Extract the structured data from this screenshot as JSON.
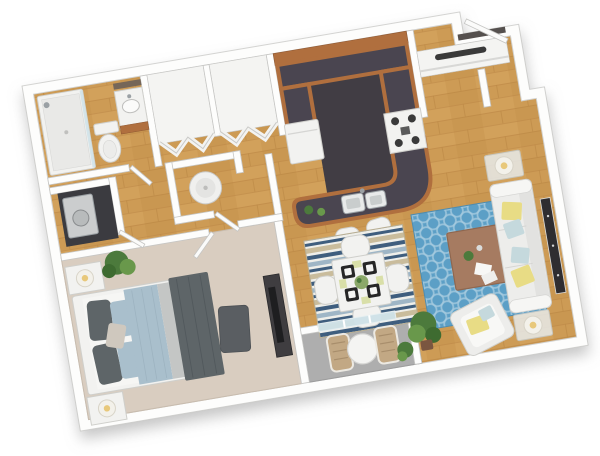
{
  "scene": {
    "type": "3d-floorplan-render",
    "view": "top-down axonometric",
    "unit": "one-bedroom one-bath apartment",
    "rooms": [
      {
        "name": "bathroom",
        "floor": "wood",
        "fixtures": [
          "walk-in shower",
          "toilet",
          "vanity with sink and mirror"
        ]
      },
      {
        "name": "hall-closet-a",
        "floor": "white",
        "fixtures": [
          "bifold doors"
        ]
      },
      {
        "name": "hall-closet-b",
        "floor": "white",
        "fixtures": [
          "bifold doors"
        ]
      },
      {
        "name": "utility-closet",
        "floor": "wood",
        "fixtures": [
          "water heater"
        ]
      },
      {
        "name": "laundry-closet",
        "floor": "dark",
        "fixtures": [
          "stacked washer-dryer"
        ]
      },
      {
        "name": "hallway",
        "floor": "wood",
        "fixtures": []
      },
      {
        "name": "bedroom",
        "floor": "carpet",
        "fixtures": [
          "bed with gray comforter and blue pillows",
          "nightstand with lamp x2",
          "ottoman",
          "media dresser with tv",
          "potted plant"
        ]
      },
      {
        "name": "kitchen",
        "floor": "dark tile",
        "fixtures": [
          "u-shaped wood cabinets with charcoal counters",
          "refrigerator",
          "range with burners",
          "peninsula with double sink",
          "bar stool x2",
          "herb plants x2"
        ]
      },
      {
        "name": "entry",
        "floor": "wood",
        "fixtures": [
          "front door (open)",
          "coat closet with shelf and rod"
        ]
      },
      {
        "name": "dining-area",
        "floor": "wood",
        "fixtures": [
          "striped area rug",
          "square white table",
          "dining chair x4",
          "black placemats x4",
          "green centerpiece"
        ]
      },
      {
        "name": "living-room",
        "floor": "wood",
        "fixtures": [
          "blue trellis rug",
          "wood coffee table",
          "white sofa with yellow and blue pillows",
          "glass side table with lamp x2",
          "armchair with yellow pillow",
          "wall tv console",
          "potted plant"
        ]
      },
      {
        "name": "balcony",
        "floor": "concrete",
        "fixtures": [
          "sliding glass door",
          "round bistro table",
          "patio chair x2",
          "potted plant"
        ]
      }
    ]
  },
  "colors": {
    "wall_fill": "#fdfdfc",
    "wall_stroke": "#c6c6c4",
    "closet_int": "#f4f4f2",
    "floor_wood": "#cd9b55",
    "wood_seam": "#b5813f",
    "wood_light": "#ddac67",
    "carpet": "#d9cdc0",
    "carpet_edge": "#c8bcae",
    "balcony_floor": "#aeaeae",
    "kitchen_floor": "#413d44",
    "counter": "#4a4550",
    "cabinet_wood": "#b06f3e",
    "cabinet_wood_dark": "#8f5832",
    "furn_white": "#f2f2f0",
    "furn_stroke": "#cfcfcb",
    "door_leaf": "#fbfbfa",
    "rug_blue": "#5c9fc6",
    "rug_trellis": "#a6cbdf",
    "stripe_navy": "#3f5e7e",
    "stripe_tan": "#c9bc9c",
    "stripe_blue": "#9fb6c6",
    "stripe_white": "#efefea",
    "bed_dark": "#5e6568",
    "bed_blue": "#a9bfcc",
    "bed_gray": "#c4c6c5",
    "pillow_accent": "#cfc8be",
    "sofa_white": "#ededeb",
    "pillow_yellow": "#e8dc85",
    "pillow_lblue": "#c5d9dd",
    "table_wood": "#a67b61",
    "table_wood_dark": "#8f674f",
    "plant": "#4c7a3c",
    "plant_light": "#69984b",
    "pot_brown": "#7a5640",
    "tv_dark": "#2f2d30",
    "dark_closet": "#3b3b40",
    "steel": "#9aa0a4",
    "glass": "#cfe2e8",
    "lamp_glow": "#e8c87a",
    "patio_chair": "#c2a884",
    "placemat": "#262626",
    "napkin": "#d9dfa8",
    "threshold": "#55504e"
  }
}
